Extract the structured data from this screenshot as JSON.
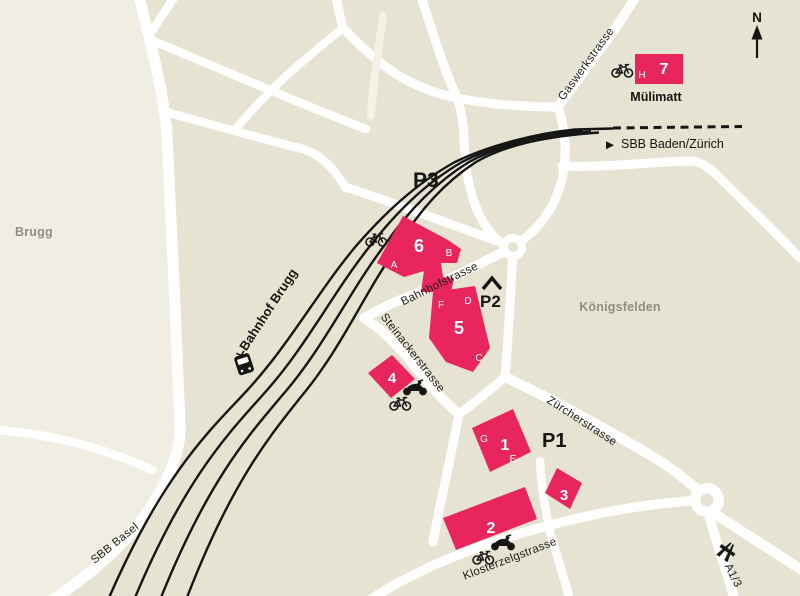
{
  "map": {
    "colors": {
      "background": "#e7e3d2",
      "background_west": "#f0eee3",
      "road": "#ffffff",
      "railway": "#161616",
      "building": "#e8255c",
      "building_text": "#ffffff",
      "area_label": "#8e8e84",
      "street_label": "#1b1b19"
    },
    "areas": {
      "brugg": "Brugg",
      "koenigsfelden": "Königsfelden",
      "muelimatt": "Mülimatt"
    },
    "station": {
      "name": "Bahnhof Brugg"
    },
    "railway_lines": {
      "sbb_basel": "SBB Basel",
      "sbb_baden_zuerich": "SBB Baden/Zürich",
      "direction_marker": "▶"
    },
    "streets": {
      "bahnhofstrasse": "Bahnhofstrasse",
      "steinackerstrasse": "Steinackerstrasse",
      "zuercherstrasse": "Zürcherstrasse",
      "klosterzelgstrasse": "Klosterzelgstrasse",
      "gaswerkstrasse": "Gaswerkstrasse"
    },
    "parking": {
      "p1": "P1",
      "p2": "P2",
      "p3": "P3"
    },
    "highway": {
      "label": "A1/3"
    },
    "compass": {
      "north": "N"
    },
    "buildings": {
      "b1": {
        "number": "1",
        "letter_g": "G",
        "letter_e": "E"
      },
      "b2": {
        "number": "2"
      },
      "b3": {
        "number": "3"
      },
      "b4": {
        "number": "4"
      },
      "b5": {
        "number": "5",
        "letter_f": "F",
        "letter_d": "D",
        "letter_c": "C"
      },
      "b6": {
        "number": "6",
        "letter_a": "A",
        "letter_b": "B"
      },
      "b7": {
        "number": "7",
        "letter_h": "H"
      }
    },
    "icons": {
      "bicycle": "bicycle-icon",
      "motorcycle": "motorcycle-icon",
      "train_station": "train-station-icon",
      "motorway": "motorway-icon",
      "north_arrow": "north-arrow-icon",
      "covered_parking_roof": "covered-parking-roof-icon"
    }
  }
}
